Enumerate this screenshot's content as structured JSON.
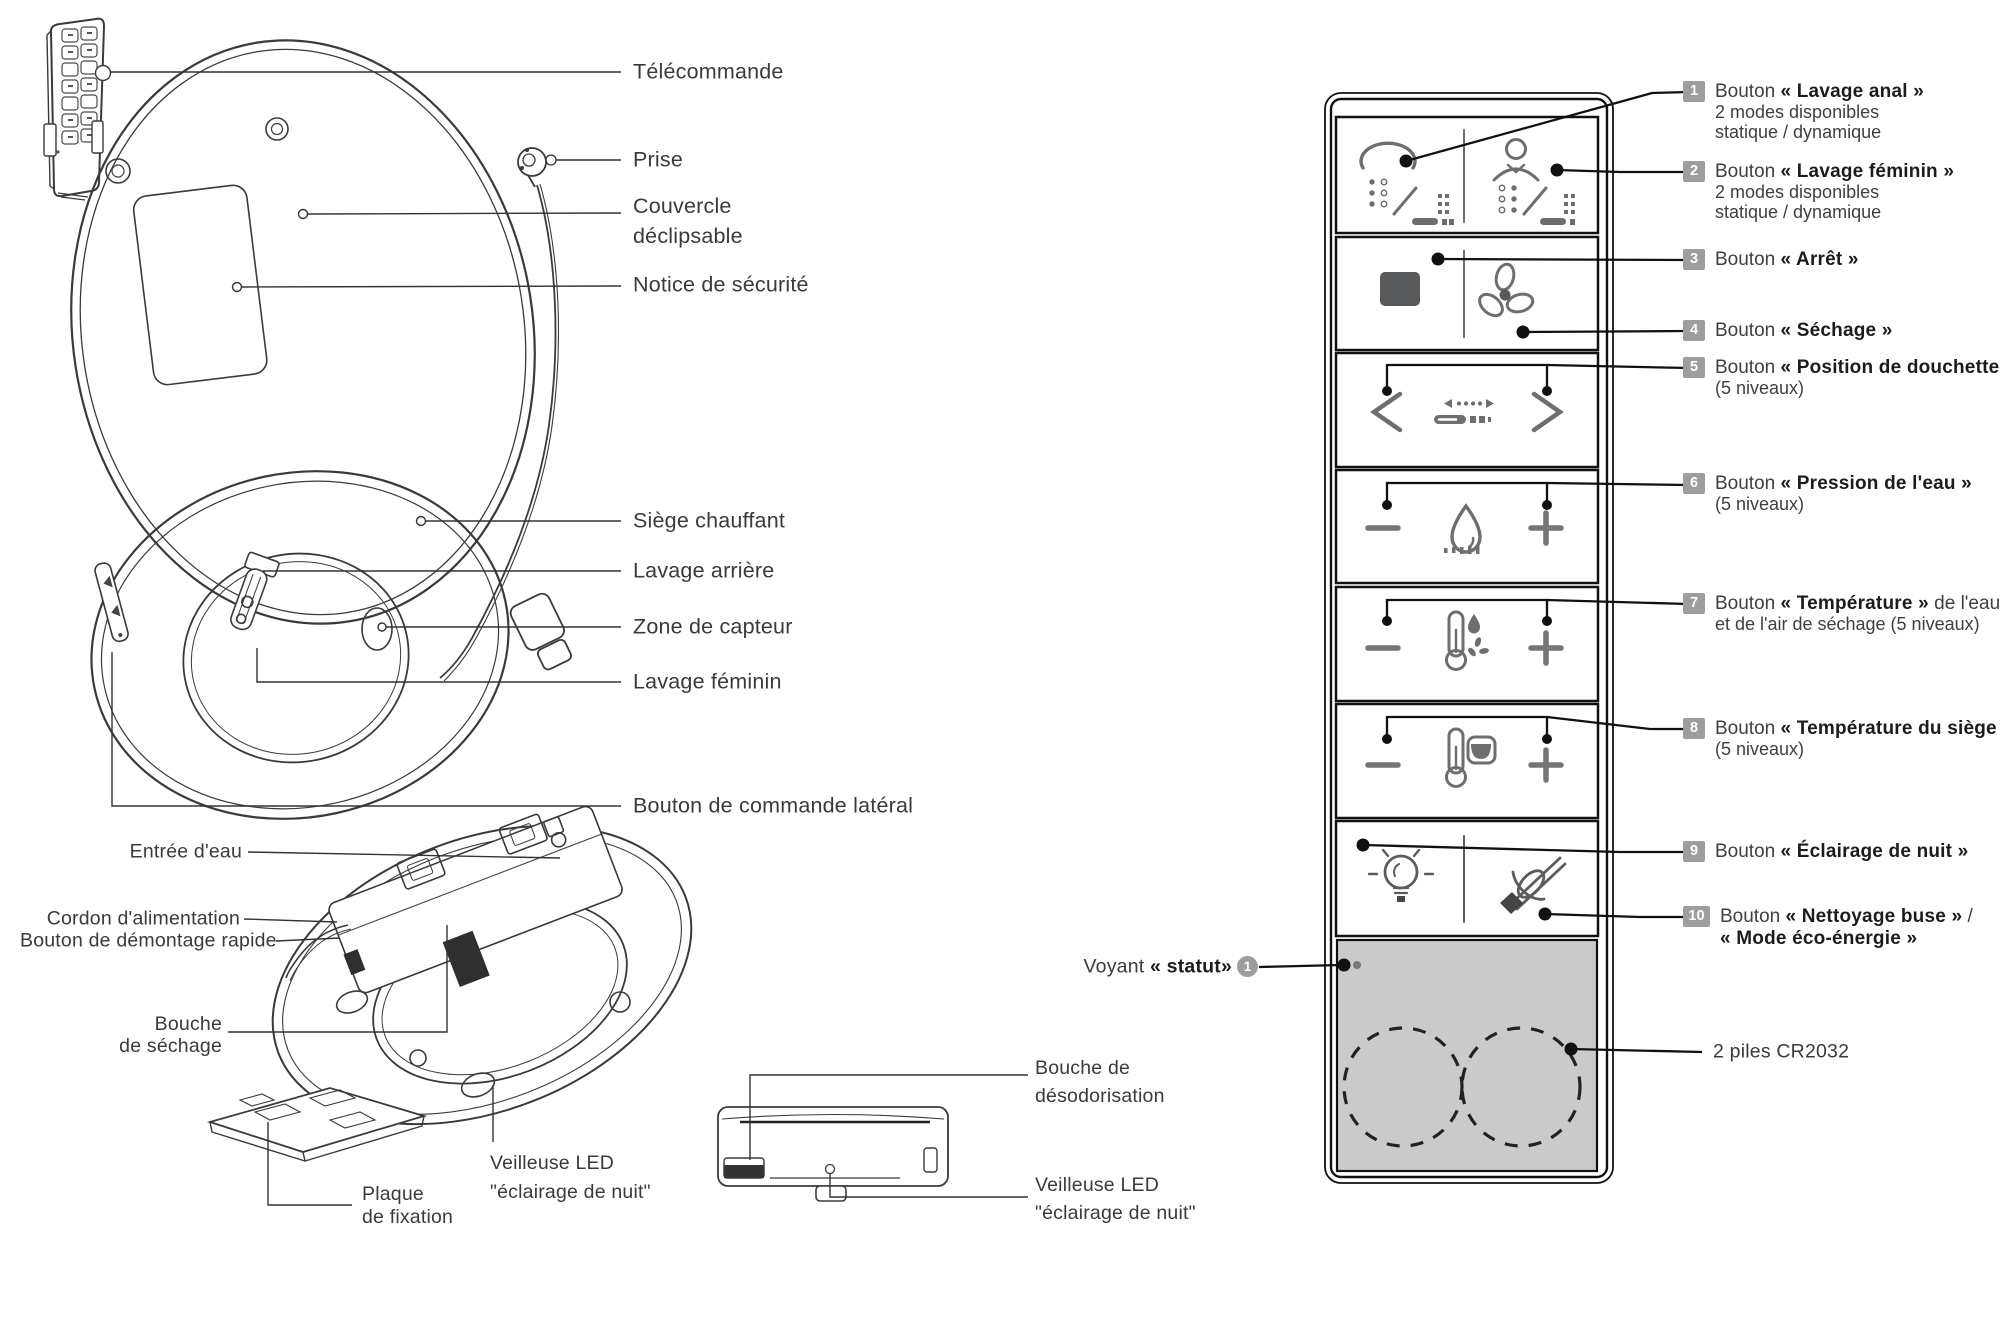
{
  "colors": {
    "ink": "#1c1c1c",
    "line_art": "#3a3a3a",
    "icon_gray": "#6e6e6e",
    "badge_gray": "#9d9d9d",
    "battery_bg": "#cacaca",
    "stop_fill": "#58595b"
  },
  "main_diagram": {
    "labels": {
      "telecommande": "Télécommande",
      "prise": "Prise",
      "couvercle_1": "Couvercle",
      "couvercle_2": "déclipsable",
      "notice": "Notice de sécurité",
      "siege": "Siège chauffant",
      "lavage_arriere": "Lavage arrière",
      "zone_capteur": "Zone de capteur",
      "lavage_feminin": "Lavage féminin",
      "bouton_lateral": "Bouton de commande latéral"
    }
  },
  "underside_diagram": {
    "labels": {
      "entree_eau": "Entrée d'eau",
      "cordon": "Cordon d'alimentation",
      "demontage": "Bouton de démontage rapide",
      "bouche_sechage_1": "Bouche",
      "bouche_sechage_2": "de séchage",
      "plaque_1": "Plaque",
      "plaque_2": "de fixation",
      "veilleuse_1": "Veilleuse LED",
      "veilleuse_2": "\"éclairage de nuit\""
    }
  },
  "side_diagram": {
    "labels": {
      "bouche_deso_1": "Bouche de",
      "bouche_deso_2": "désodorisation",
      "veilleuse_1": "Veilleuse LED",
      "veilleuse_2": "\"éclairage de nuit\""
    }
  },
  "control_panel": {
    "rows": [
      {
        "num": "1",
        "prefix": "Bouton ",
        "strong": "« Lavage anal »",
        "sub1": "2 modes disponibles",
        "sub2": "statique / dynamique"
      },
      {
        "num": "2",
        "prefix": "Bouton ",
        "strong": "« Lavage féminin »",
        "sub1": "2 modes disponibles",
        "sub2": "statique / dynamique"
      },
      {
        "num": "3",
        "prefix": "Bouton ",
        "strong": "« Arrêt »"
      },
      {
        "num": "4",
        "prefix": "Bouton ",
        "strong": "« Séchage »"
      },
      {
        "num": "5",
        "prefix": "Bouton ",
        "strong": "« Position de douchette »",
        "sub1": "(5 niveaux)"
      },
      {
        "num": "6",
        "prefix": "Bouton ",
        "strong": "« Pression de l'eau »",
        "sub1": "(5 niveaux)"
      },
      {
        "num": "7",
        "prefix": "Bouton ",
        "strong": "« Température »",
        "suffix": " de l'eau",
        "sub1": "et de l'air de séchage (5 niveaux)"
      },
      {
        "num": "8",
        "prefix": "Bouton ",
        "strong": "« Température du siège »",
        "sub1": "(5 niveaux)"
      },
      {
        "num": "9",
        "prefix": "Bouton ",
        "strong": "« Éclairage de nuit »"
      },
      {
        "num": "10",
        "prefix": "Bouton ",
        "strong": "« Nettoyage buse »",
        "suffix": " /",
        "strong2": "« Mode éco-énergie »"
      }
    ],
    "voyant": {
      "prefix": "Voyant ",
      "strong": "« statut»",
      "badge": "1"
    },
    "piles": "2 piles CR2032"
  }
}
